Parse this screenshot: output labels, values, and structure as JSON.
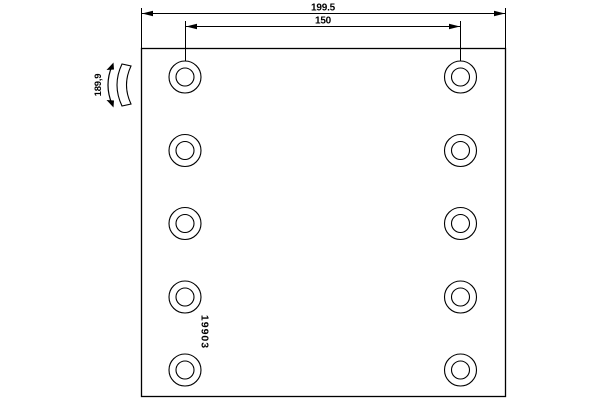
{
  "drawing": {
    "type": "brake-lining-technical-drawing",
    "dimensions": {
      "total_width": "199.5",
      "hole_spacing": "150",
      "radius": "189,9"
    },
    "part_number": "19903"
  },
  "plate": {
    "hole_columns": 2,
    "hole_rows": 5,
    "hole_count": 10
  },
  "geometry": {
    "hole_cols": [
      185,
      460.5
    ],
    "hole_rows": [
      77,
      150.5,
      223.5,
      297,
      370
    ],
    "outer_r": 16,
    "inner_r": 9
  },
  "colors": {
    "line": "#000000",
    "background": "#ffffff"
  }
}
